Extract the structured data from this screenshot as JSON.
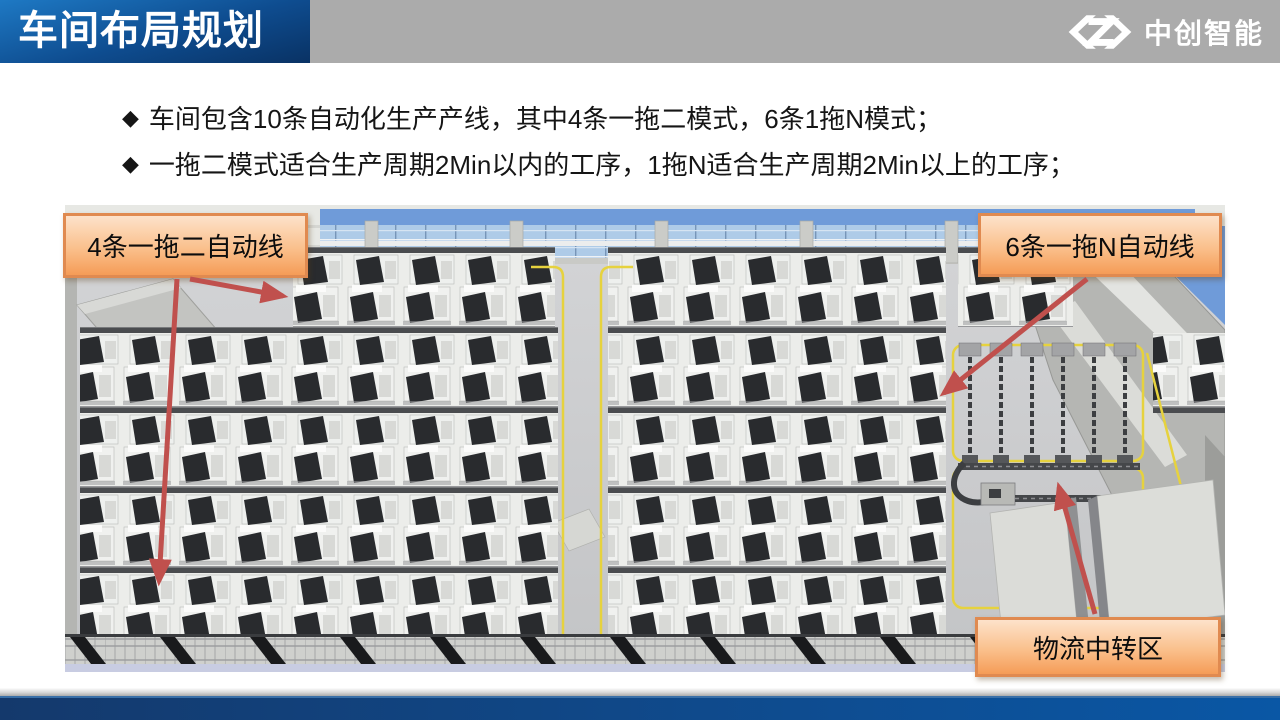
{
  "slide": {
    "title": "车间布局规划"
  },
  "logo": {
    "name": "中创智能"
  },
  "bullets": {
    "marker": "◆",
    "items": [
      "车间包含10条自动化生产产线，其中4条一拖二模式，6条1拖N模式；",
      "一拖二模式适合生产周期2Min以内的工序，1拖N适合生产周期2Min以上的工序；"
    ]
  },
  "callouts": {
    "left": "4条一拖二自动线",
    "right": "6条一拖N自动线",
    "bottom": "物流中转区"
  },
  "scene_labels": {
    "description": "3D overhead rendering of workshop with rows of CNC machine lines, center aisle, logistics transfer area with conveyors, skylight roof and mezzanine grating"
  },
  "colors": {
    "banner_blue_dark": "#093264",
    "banner_blue_light": "#1E79C4",
    "header_gray": "#ABABAB",
    "callout_fill_top": "#FDE2CA",
    "callout_fill_bottom": "#F59C57",
    "callout_border": "#E08A50",
    "arrow_red": "#C0504D",
    "footer_blue_left": "#14396C",
    "footer_blue_right": "#0A57A5",
    "floor_gray": "#C9CACB",
    "sky_blue": "#6F9BD9",
    "floor_marking_yellow": "#E6D23E"
  }
}
